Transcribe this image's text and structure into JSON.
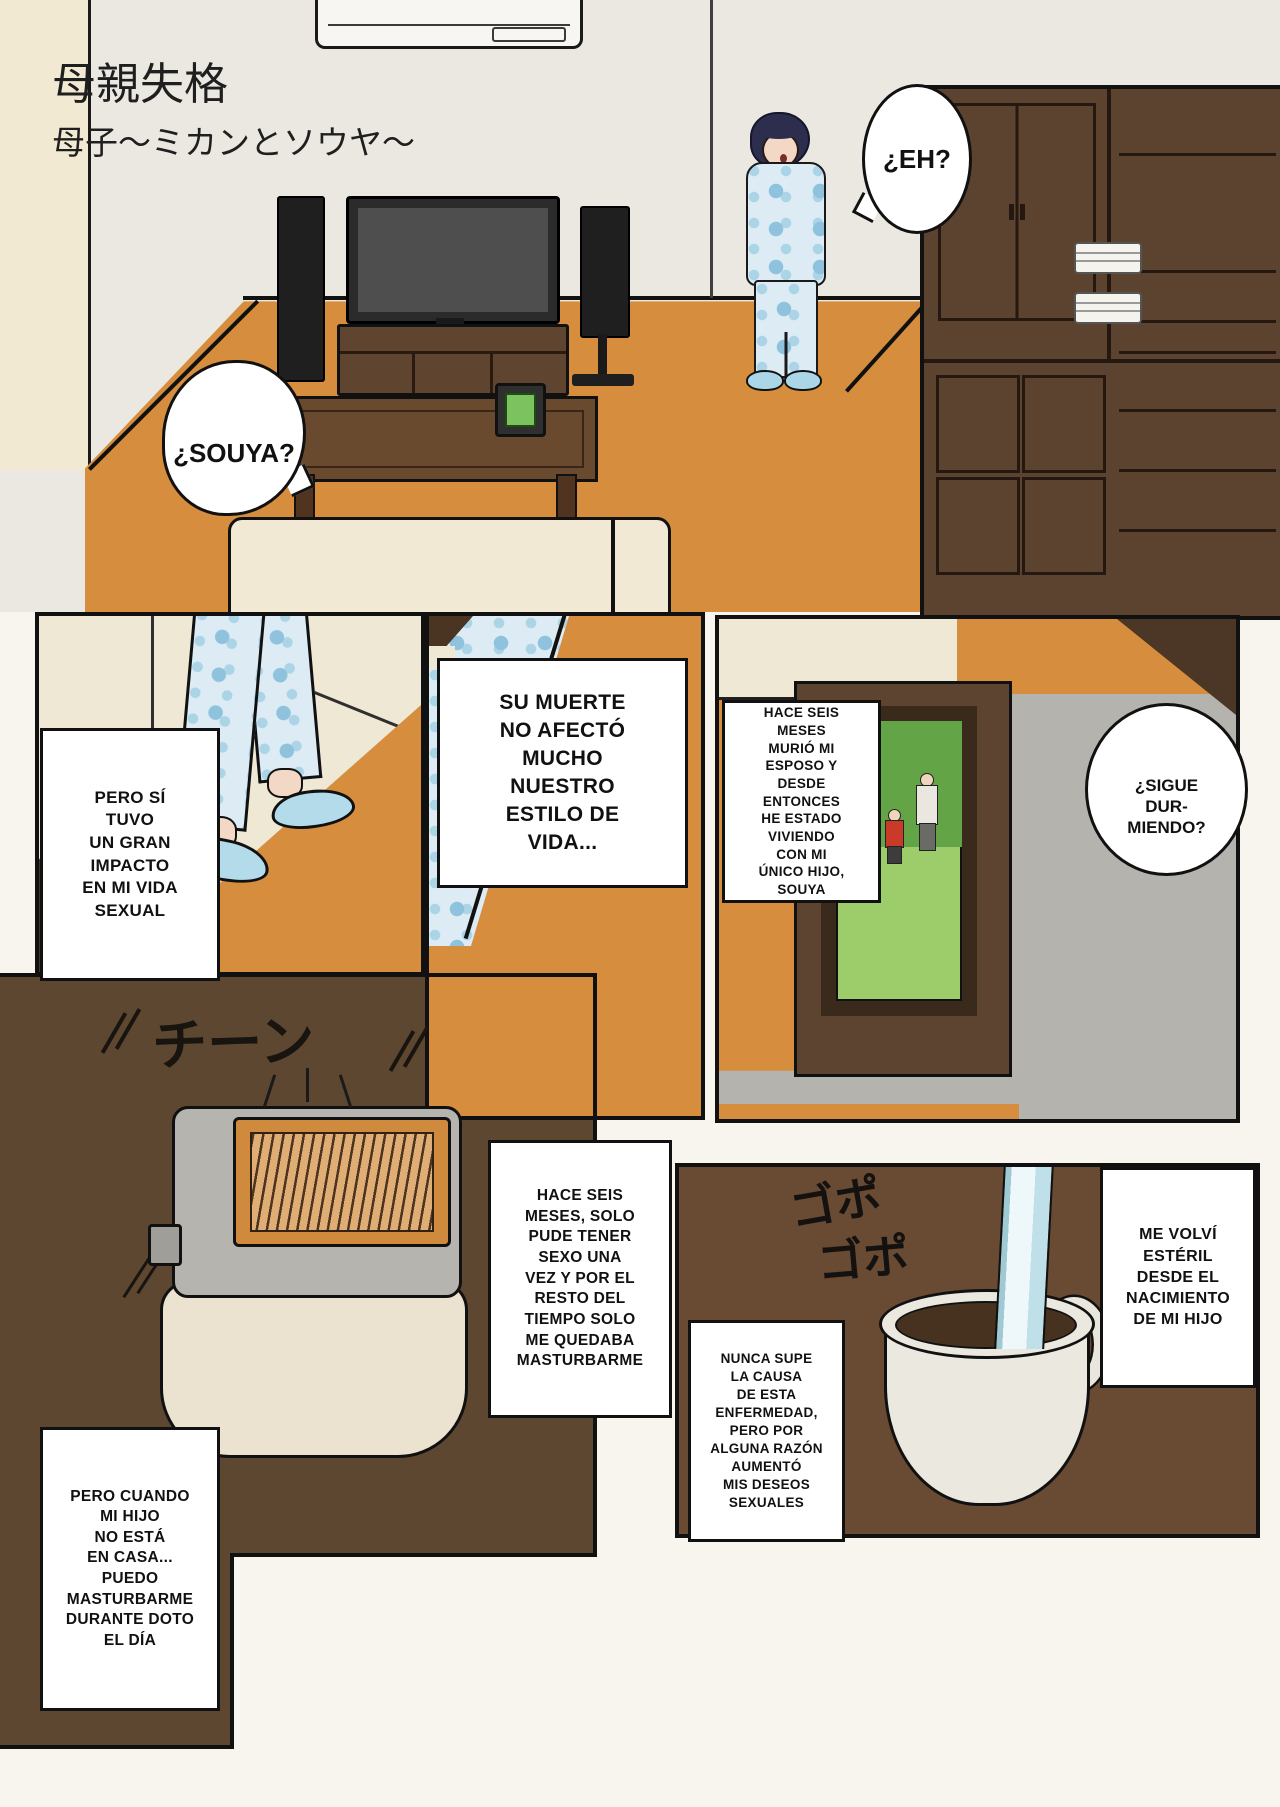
{
  "title": {
    "line1": "母親失格",
    "line2": "母子～ミカンとソウヤ～"
  },
  "bubbles": {
    "eh": "¿EH?",
    "souya": "¿SOUYA?",
    "sigue": "¿SIGUE\nDUR-\nMIENDO?"
  },
  "captions": {
    "pero_si": "PERO SÍ\nTUVO\nUN GRAN\nIMPACTO\nEN MI VIDA\nSEXUAL",
    "su_muerte": "SU MUERTE\nNO AFECTÓ\nMUCHO\nNUESTRO\nESTILO DE\nVIDA...",
    "hace_seis_murio": "HACE SEIS\nMESES\nMURIÓ MI\nESPOSO Y\nDESDE\nENTONCES\nHE ESTADO\nVIVIENDO\nCON MI\nÚNICO HIJO,\nSOUYA",
    "hace_seis_solo": "HACE SEIS\nMESES, SOLO\nPUDE TENER\nSEXO UNA\nVEZ Y POR EL\nRESTO DEL\nTIEMPO SOLO\nME QUEDABA\nMASTURBARME",
    "nunca_supe": "NUNCA SUPE\nLA CAUSA\nDE ESTA\nENFERMEDAD,\nPERO POR\nALGUNA RAZÓN\nAUMENTÓ\nMIS DESEOS\nSEXUALES",
    "me_volvi": "ME VOLVÍ\nESTÉRIL\nDESDE EL\nNACIMIENTO\nDE MI HIJO",
    "pero_cuando": "PERO CUANDO\nMI HIJO\nNO ESTÁ\nEN CASA...\nPUEDO\nMASTURBARME\nDURANTE DOTO\nEL DÍA"
  },
  "sfx": {
    "toaster_ding": "チーン",
    "pour_1": "ゴポ",
    "pour_2": "ゴポ"
  },
  "colors": {
    "floor_orange": "#d68e3e",
    "wood_dark_brown": "#5b4330",
    "panel_brown": "#694a33",
    "pajama_blue": "#dcebf4",
    "pajama_dot_blue": "#8fc3dd",
    "wall_gray": "#ebe8e1",
    "wall_cream": "#f2e9d2",
    "bed_gray": "#b5b3ad",
    "photo_green": "#9ccd6a",
    "coffee_dark": "#47311f",
    "water_blue": "#d9eef2",
    "couch_cream": "#f1e9d4",
    "ink_black": "#111111"
  }
}
